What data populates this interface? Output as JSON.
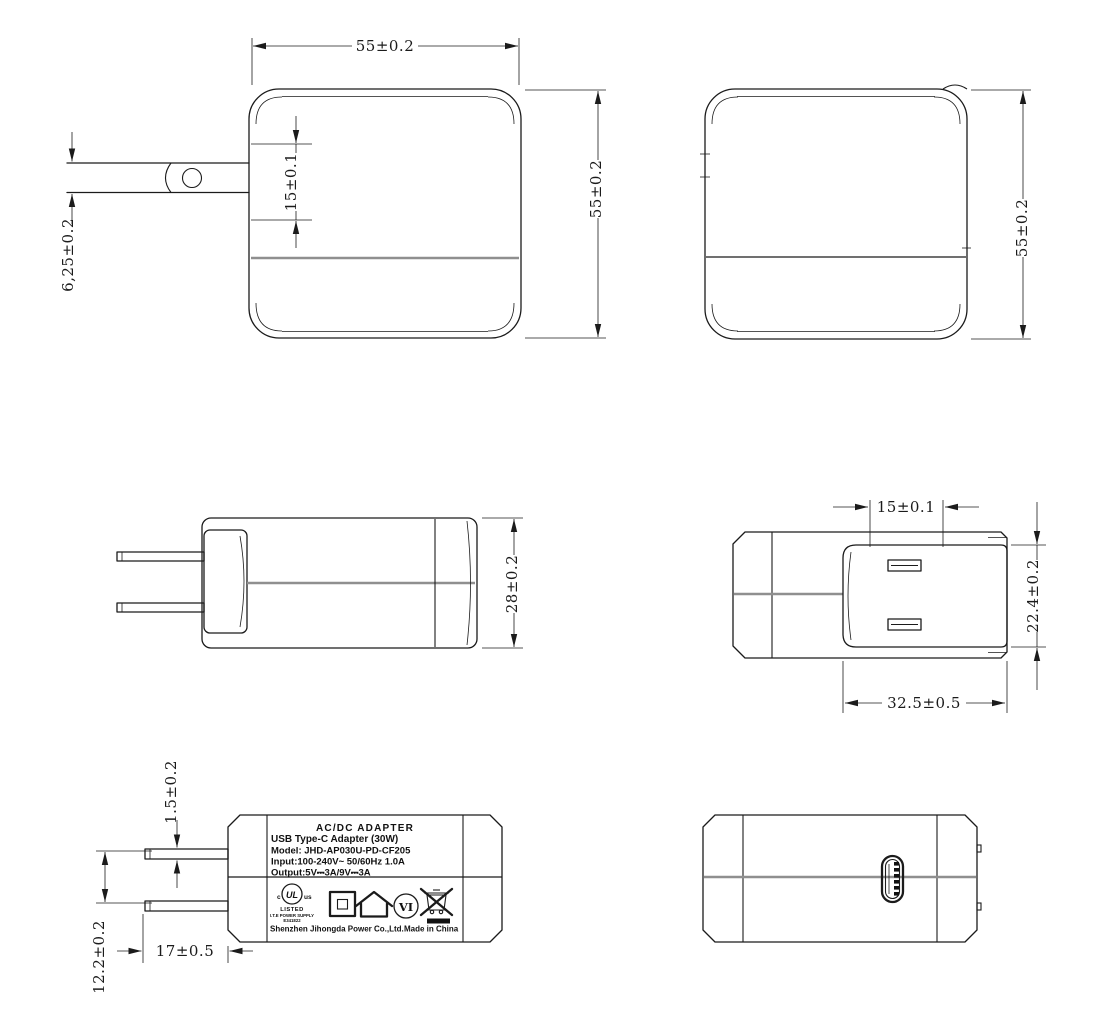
{
  "drawing": {
    "background": "#ffffff",
    "line_color": "#1b1b1b",
    "seam_color": "#8f8f8f"
  },
  "views": {
    "front": {
      "dims": {
        "width": "55±0.2",
        "height": "55±0.2",
        "plug_recess": "15±0.1",
        "prong_width": "6,25±0.2"
      }
    },
    "rear": {
      "dims": {
        "height": "55±0.2"
      }
    },
    "side": {
      "dims": {
        "depth": "28±0.2"
      }
    },
    "top": {
      "dims": {
        "prong_pitch": "15±0.1",
        "plug_face_depth": "22.4±0.2",
        "plug_face_width": "32.5±0.5"
      }
    },
    "label": {
      "dims": {
        "prong_thickness": "1.5±0.2",
        "prong_gap": "12.2±0.2",
        "prong_length": "17±0.5"
      },
      "text": {
        "title": "AC/DC  ADAPTER",
        "subtitle": "USB Type-C Adapter   (30W)",
        "model": "Model: JHD-AP030U-PD-CF205",
        "input": "Input:100-240V~  50/60Hz  1.0A",
        "output": "Output:5V⎓3A/9V⎓3A",
        "ul": {
          "c": "c",
          "logo": "UL",
          "us": "us",
          "listed": "LISTED",
          "category": "I.T.E POWER SUPPLY",
          "file": "E341822"
        },
        "efficiency": "VI",
        "company": "Shenzhen Jihongda Power Co.,Ltd.",
        "made_in": "Made in China"
      }
    }
  }
}
